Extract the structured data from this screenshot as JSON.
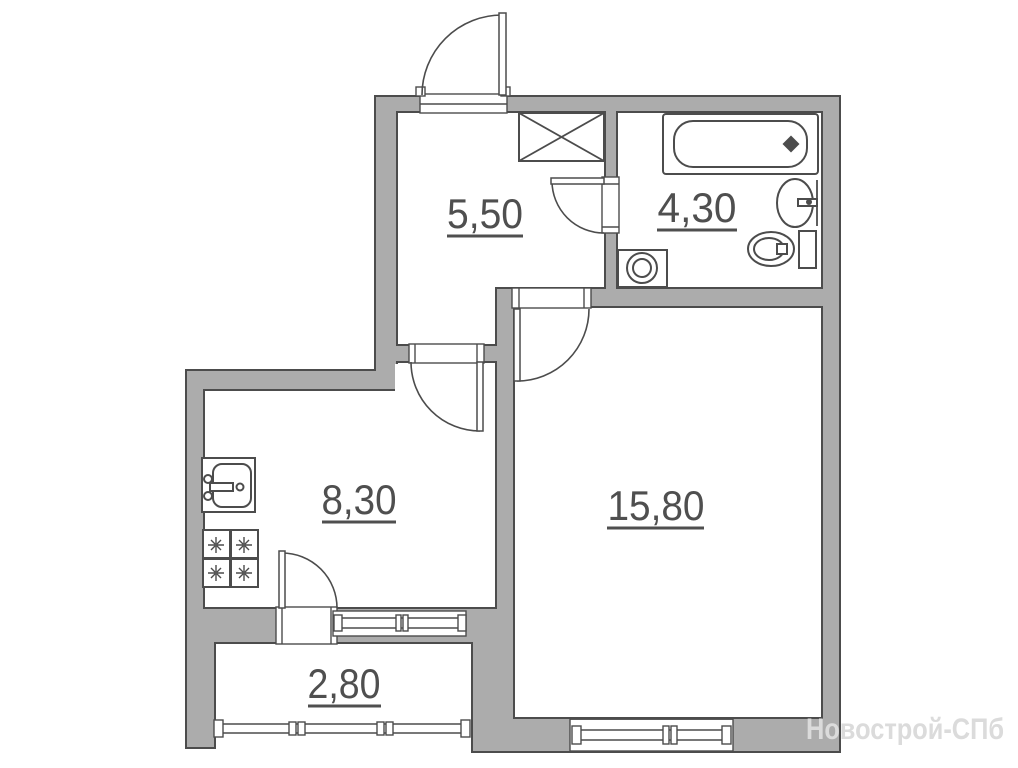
{
  "plan": {
    "type": "apartment-floor-plan",
    "rooms": {
      "hallway": {
        "area_label": "5,50"
      },
      "bathroom": {
        "area_label": "4,30"
      },
      "kitchen": {
        "area_label": "8,30"
      },
      "living_room": {
        "area_label": "15,80"
      },
      "balcony": {
        "area_label": "2,80"
      }
    },
    "fixtures": [
      "entrance-door",
      "wardrobe",
      "bathtub",
      "bathroom-sink",
      "toilet",
      "washing-machine",
      "kitchen-sink",
      "stove",
      "bathroom-door",
      "kitchen-door",
      "living-room-door",
      "balcony-door",
      "kitchen-window",
      "living-room-window",
      "balcony-glazing"
    ]
  },
  "watermark": {
    "text": "Новострой-СПб"
  },
  "colors": {
    "background": "#FFFFFF",
    "wall_fill": "#ACACAC",
    "line": "#4C4C4C",
    "label_text": "#4F4F4F",
    "watermark_text": "#DBDBDB"
  }
}
